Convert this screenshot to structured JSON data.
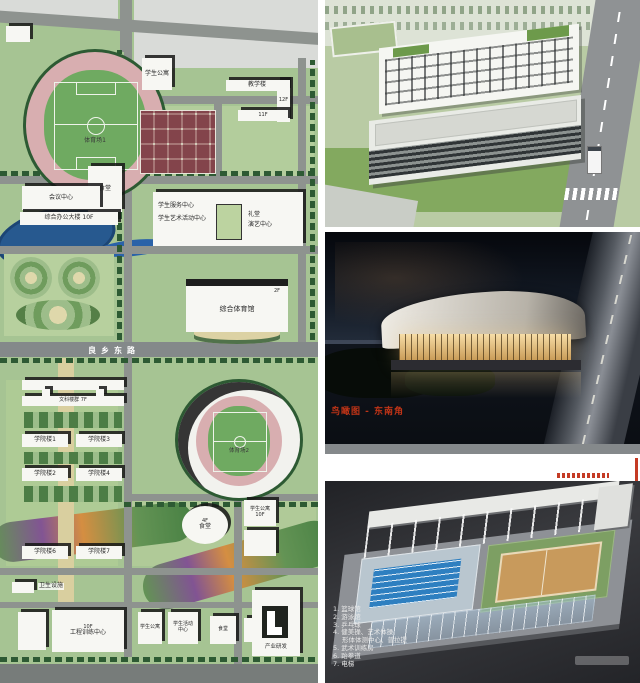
{
  "map": {
    "road_label": "良乡东路",
    "labels": {
      "stadium1": "体育场1",
      "canteen_top": "食堂",
      "dorm_top": "学生公寓",
      "teaching": "教学楼",
      "teaching_floor1": "12F",
      "teaching_floor2": "11F",
      "conference": "会议中心",
      "office": "综合办公大楼 10F",
      "service": "学生服务中心",
      "art_activity": "学生艺术活动中心",
      "auditorium_l1": "礼堂",
      "auditorium_l2": "演艺中心",
      "gym": "综合体育馆",
      "gym_floor": "2F",
      "liberal_arts": "文科楼群 7F",
      "college1": "学院楼1",
      "college2": "学院楼2",
      "college3": "学院楼3",
      "college4": "学院楼4",
      "college6": "学院楼6",
      "college7": "学院楼7",
      "stadium2": "体育场2",
      "canteen2": "食堂",
      "canteen2_floor": "4F",
      "dorm_east": "学生公寓 10F",
      "sanitation": "卫生设施",
      "engineering": "工程训练中心",
      "engineering_floor": "10F",
      "dorm_south": "学生公寓",
      "activity_south": "学生活动中心",
      "canteen_south": "食堂",
      "industry": "产业研发"
    }
  },
  "night_panel": {
    "caption": "鸟瞰图 - 东南角"
  },
  "cutaway_panel": {
    "legend": [
      "1. 篮球馆",
      "2. 游泳馆",
      "3. 乒乓球",
      "4. 健美操、艺术体操",
      "形体体测中心、普拉提",
      "5. 武术训练房",
      "6. 跆拳道",
      "7. 电梯"
    ]
  },
  "colors": {
    "caption_red": "#bf3417",
    "map_green": "#a6c493",
    "night_glow": "#f7dda6"
  }
}
